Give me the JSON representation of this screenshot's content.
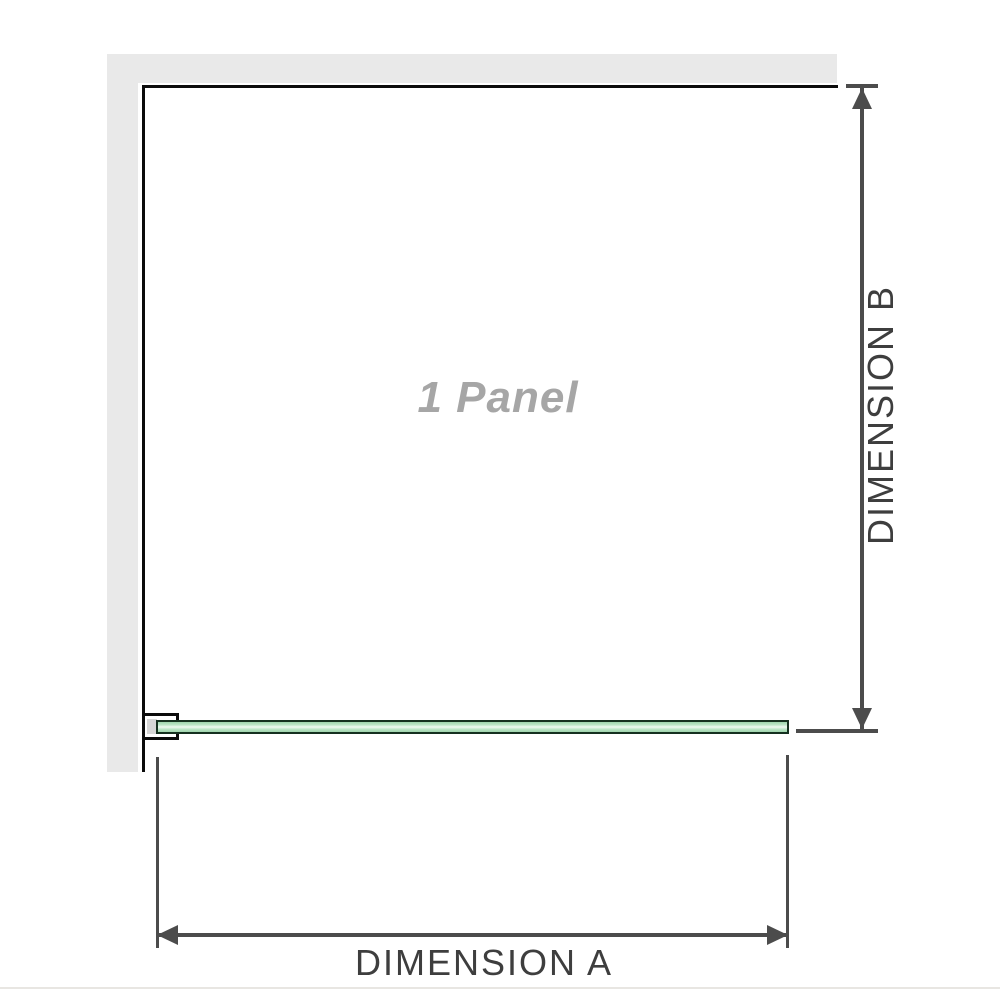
{
  "diagram": {
    "panel_label": "1 Panel",
    "dimension_a_label": "DIMENSION A",
    "dimension_b_label": "DIMENSION B"
  },
  "icons": {
    "dimension_b_arrows": [
      "arrow-up-icon",
      "arrow-down-icon"
    ],
    "dimension_a_arrows": [
      "arrow-left-icon",
      "arrow-right-icon"
    ]
  },
  "colors": {
    "wall": "#e9e9e9",
    "outline": "#0b0b0b",
    "dimension": "#4c4c4c",
    "dimension_text": "#3e3e3e",
    "panel_text": "#a6a6a6",
    "glass_border": "#15301f",
    "glass_green": "#9ed4ac",
    "glass_mid": "#bce5c7",
    "glass_highlight": "#f0f9f2",
    "bracket_channel": "#d6d6d6",
    "divider": "#e8e6e2"
  }
}
